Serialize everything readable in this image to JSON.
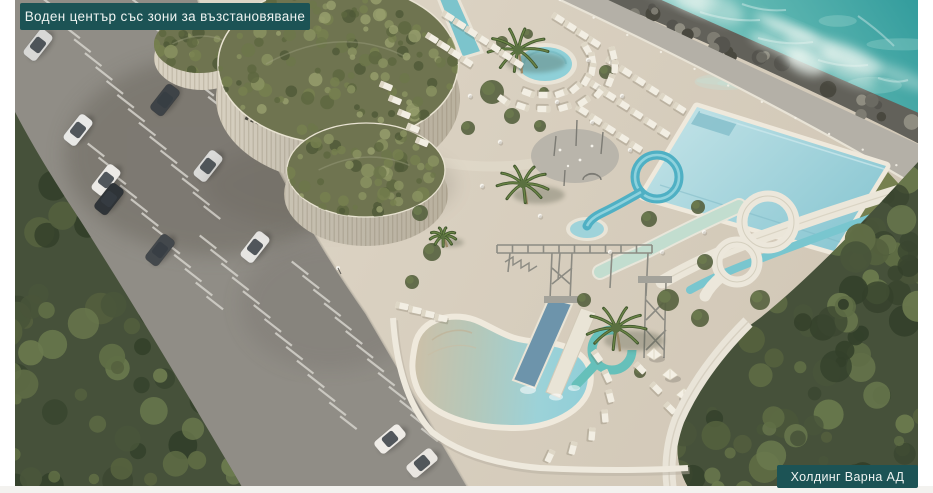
{
  "badges": {
    "title": {
      "text": "Воден център със зони за възстановяване",
      "background": "#1c5355",
      "text_color": "#eef3f1"
    },
    "credit": {
      "text": "Холдинг Варна АД",
      "background": "#1c5355",
      "text_color": "#eef3f1"
    }
  },
  "scene": {
    "type": "architectural-aerial-rendering",
    "features": [
      "sea",
      "breakwater-rocks",
      "seaside-promenade",
      "main-pool",
      "kids-pool",
      "round-pool",
      "lazy-pool",
      "splash-pad",
      "water-slides",
      "green-roof-building",
      "parking-lot",
      "palm-trees",
      "sun-loungers",
      "umbrellas",
      "trees"
    ],
    "colors": {
      "sea_deep": "#339a9b",
      "sea_light": "#7fc8c2",
      "foam": "#eef7f2",
      "rocks": "#62615a",
      "promenade": "#b4b0a7",
      "deck_light": "#e2dbcc",
      "deck_dark": "#cfc5b4",
      "asphalt": "#908d86",
      "asphalt_shadow": "#6e6a62",
      "stripe": "#d5d2cb",
      "building_wall": "#d8d1c1",
      "green_roof": "#6f7450",
      "pool_water": "#a9d6dc",
      "pool_rim": "#efe9dc",
      "kidney_sand": "#ccc0a8",
      "kidney_water": "#8fced8",
      "slide_cyan": "#4fb0c4",
      "slide_mint": "#c2ddcf",
      "slide_white": "#ebe6d9",
      "slide_blue": "#6d94ab",
      "tree_dark": "#46513a",
      "tree_mid": "#5a6842",
      "lounger": "#f2eee3",
      "truss": "#8c8b83"
    }
  }
}
